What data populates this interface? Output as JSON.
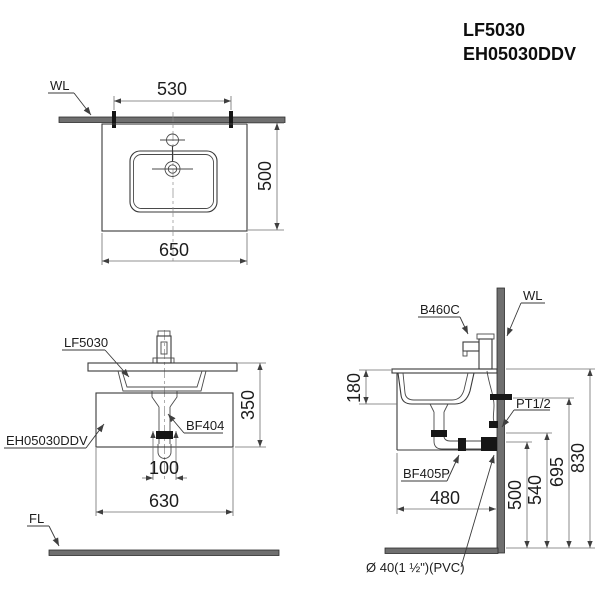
{
  "title": {
    "model_1": "LF5030",
    "model_2": "EH05030DDV"
  },
  "colors": {
    "line": "#3a3a3a",
    "dim_line": "#6e6e6e",
    "wall_fill": "#6f6f6f",
    "fitting_black": "#161616",
    "background": "#ffffff"
  },
  "top_view": {
    "wall_label": "WL",
    "dim_hanger_spacing": "530",
    "dim_depth": "500",
    "dim_width": "650"
  },
  "front_view": {
    "label_basin": "LF5030",
    "label_cabinet": "EH05030DDV",
    "label_drain": "BF404",
    "label_floor": "FL",
    "dim_height": "350",
    "dim_drain_width": "100",
    "dim_cabinet_width": "630"
  },
  "side_view": {
    "label_faucet": "B460C",
    "label_wall": "WL",
    "label_supply": "PT1/2",
    "label_trap": "BF405P",
    "label_outlet": "Ø 40(1 ½\")(PVC)",
    "dim_basin_depth": "180",
    "dim_cabinet_depth": "480",
    "dim_outlet_center_height": "500",
    "dim_outlet_top_height": "540",
    "dim_supply_height": "695",
    "dim_counter_height": "830"
  }
}
